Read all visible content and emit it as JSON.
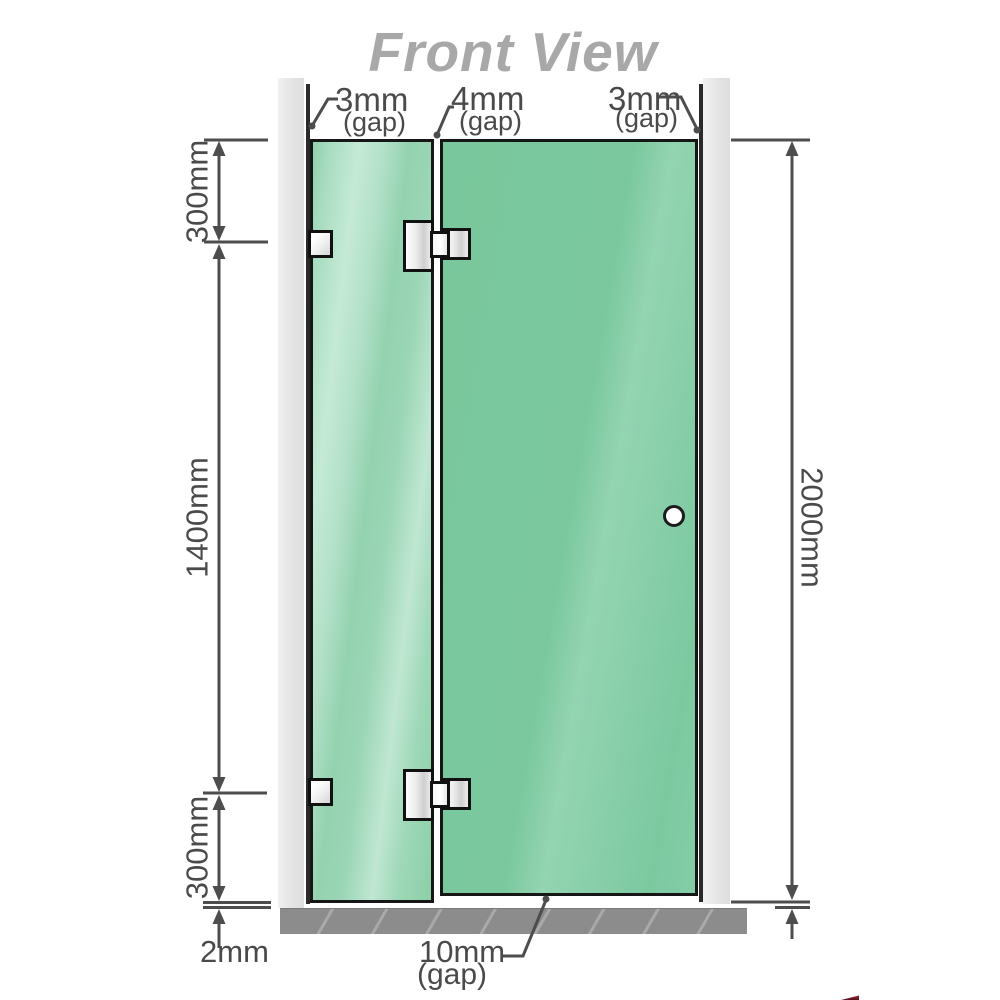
{
  "title": "Front View",
  "gap_labels": {
    "top_left": {
      "value": "3mm",
      "note": "(gap)"
    },
    "top_middle": {
      "value": "4mm",
      "note": "(gap)"
    },
    "top_right": {
      "value": "3mm",
      "note": "(gap)"
    },
    "bottom": {
      "value": "10mm",
      "note": "(gap)"
    }
  },
  "dimension_labels": {
    "top_left_height": "300mm",
    "middle_left_height": "1400mm",
    "bottom_left_height": "300mm",
    "overall_height": "2000mm",
    "floor_clearance": "2mm"
  },
  "colors": {
    "door_glass": "#7cc9a0",
    "fixed_panel_glass": "#9cd6b5",
    "wall_channel": "#e9e9e9",
    "floor": "#8c8c8c",
    "dimension_line": "#4d4d4d",
    "title_text": "#a8a8a8"
  }
}
